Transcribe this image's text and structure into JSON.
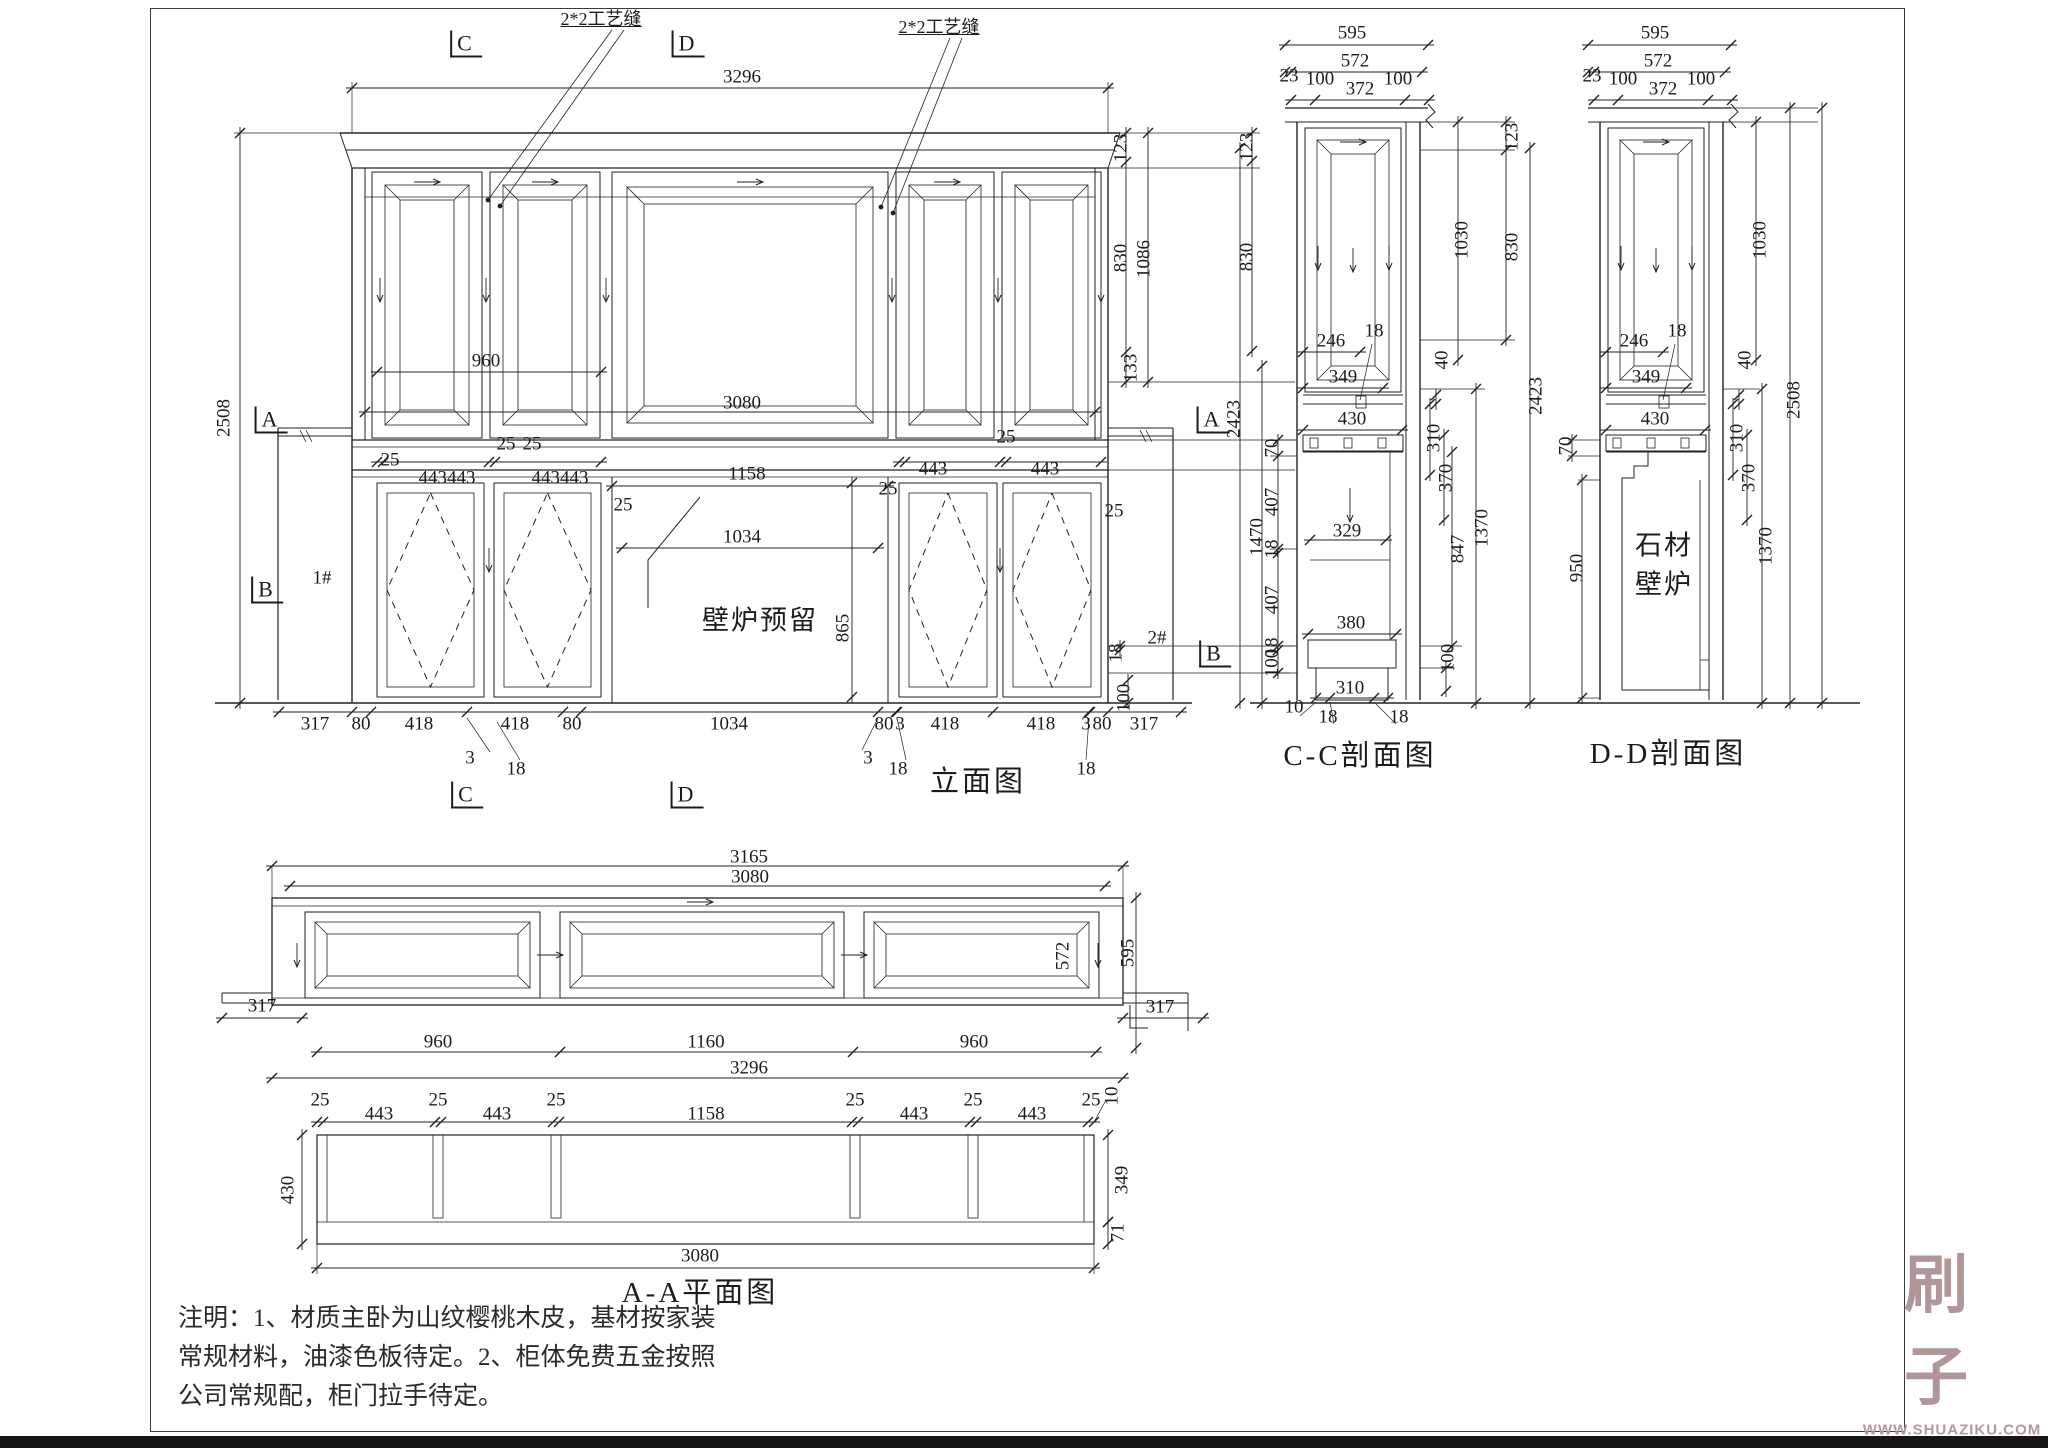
{
  "views": {
    "elevation": {
      "title": "立面图"
    },
    "section_cc": {
      "title": "C-C剖面图"
    },
    "section_dd": {
      "title": "D-D剖面图"
    },
    "plan_aa": {
      "title": "A-A平面图"
    }
  },
  "annotations": {
    "craft_seam": "2*2工艺缝",
    "fireplace_reserved": "壁炉预留",
    "stone_line1": "石材",
    "stone_line2": "壁炉",
    "unit1": "1#",
    "unit2": "2#"
  },
  "notes": {
    "lines": [
      "注明：1、材质主卧为山纹樱桃木皮，基材按家装",
      "常规材料，油漆色板待定。2、柜体免费五金按照",
      "公司常规配，柜门拉手待定。"
    ]
  },
  "watermark": {
    "logo": "刷子库",
    "url": "WWW.SHUAZIKU.COM",
    "color": "#a88b8b"
  },
  "labels": [
    {
      "t": "2*2工艺缝",
      "x": 601,
      "y": 19,
      "k": "callout"
    },
    {
      "t": "2*2工艺缝",
      "x": 939,
      "y": 27,
      "k": "callout"
    },
    {
      "t": "C",
      "x": 466,
      "y": 44,
      "k": "marker"
    },
    {
      "t": "D",
      "x": 688,
      "y": 44,
      "k": "marker"
    },
    {
      "t": "3296",
      "x": 742,
      "y": 77
    },
    {
      "t": "2508",
      "x": 224,
      "y": 418,
      "r": 1
    },
    {
      "t": "A",
      "x": 271,
      "y": 420,
      "k": "marker"
    },
    {
      "t": "B",
      "x": 267,
      "y": 590,
      "k": "marker"
    },
    {
      "t": "1#",
      "x": 322,
      "y": 578
    },
    {
      "t": "960",
      "x": 486,
      "y": 361
    },
    {
      "t": "3080",
      "x": 742,
      "y": 403
    },
    {
      "t": "25",
      "x": 506,
      "y": 444
    },
    {
      "t": "25",
      "x": 532,
      "y": 444
    },
    {
      "t": "25",
      "x": 390,
      "y": 460
    },
    {
      "t": "443443",
      "x": 447,
      "y": 478
    },
    {
      "t": "443443",
      "x": 560,
      "y": 478
    },
    {
      "t": "1158",
      "x": 747,
      "y": 474
    },
    {
      "t": "25",
      "x": 623,
      "y": 505
    },
    {
      "t": "443",
      "x": 933,
      "y": 469
    },
    {
      "t": "443",
      "x": 1045,
      "y": 469
    },
    {
      "t": "25",
      "x": 1006,
      "y": 437
    },
    {
      "t": "25",
      "x": 888,
      "y": 489
    },
    {
      "t": "25",
      "x": 1114,
      "y": 511
    },
    {
      "t": "1034",
      "x": 742,
      "y": 537
    },
    {
      "t": "865",
      "x": 843,
      "y": 628,
      "r": 1
    },
    {
      "t": "壁炉预留",
      "x": 760,
      "y": 621,
      "k": "text"
    },
    {
      "t": "2#",
      "x": 1157,
      "y": 638
    },
    {
      "t": "123",
      "x": 1121,
      "y": 148,
      "r": 1
    },
    {
      "t": "830",
      "x": 1121,
      "y": 258,
      "r": 1
    },
    {
      "t": "1086",
      "x": 1144,
      "y": 259,
      "r": 1
    },
    {
      "t": "133",
      "x": 1131,
      "y": 368,
      "r": 1
    },
    {
      "t": "123",
      "x": 1247,
      "y": 147,
      "r": 1
    },
    {
      "t": "830",
      "x": 1247,
      "y": 257,
      "r": 1
    },
    {
      "t": "A",
      "x": 1213,
      "y": 420,
      "k": "marker"
    },
    {
      "t": "2423",
      "x": 1234,
      "y": 419,
      "r": 1
    },
    {
      "t": "70",
      "x": 1272,
      "y": 448,
      "r": 1
    },
    {
      "t": "407",
      "x": 1272,
      "y": 502,
      "r": 1
    },
    {
      "t": "18",
      "x": 1272,
      "y": 549,
      "r": 1
    },
    {
      "t": "407",
      "x": 1272,
      "y": 600,
      "r": 1
    },
    {
      "t": "18",
      "x": 1272,
      "y": 647,
      "r": 1
    },
    {
      "t": "100",
      "x": 1272,
      "y": 663,
      "r": 1
    },
    {
      "t": "1470",
      "x": 1257,
      "y": 537,
      "r": 1
    },
    {
      "t": "B",
      "x": 1215,
      "y": 654,
      "k": "marker"
    },
    {
      "t": "18",
      "x": 1116,
      "y": 653,
      "r": 1
    },
    {
      "t": "100",
      "x": 1124,
      "y": 698,
      "r": 1
    },
    {
      "t": "317",
      "x": 315,
      "y": 724
    },
    {
      "t": "80",
      "x": 361,
      "y": 724
    },
    {
      "t": "418",
      "x": 419,
      "y": 724
    },
    {
      "t": "418",
      "x": 515,
      "y": 724
    },
    {
      "t": "80",
      "x": 572,
      "y": 724
    },
    {
      "t": "1034",
      "x": 729,
      "y": 724
    },
    {
      "t": "80",
      "x": 884,
      "y": 724
    },
    {
      "t": "3",
      "x": 900,
      "y": 724
    },
    {
      "t": "418",
      "x": 945,
      "y": 724
    },
    {
      "t": "418",
      "x": 1041,
      "y": 724
    },
    {
      "t": "3",
      "x": 1086,
      "y": 724
    },
    {
      "t": "80",
      "x": 1102,
      "y": 724
    },
    {
      "t": "317",
      "x": 1144,
      "y": 724
    },
    {
      "t": "3",
      "x": 470,
      "y": 758
    },
    {
      "t": "18",
      "x": 516,
      "y": 769
    },
    {
      "t": "3",
      "x": 868,
      "y": 758
    },
    {
      "t": "18",
      "x": 898,
      "y": 769
    },
    {
      "t": "18",
      "x": 1086,
      "y": 769
    },
    {
      "t": "C",
      "x": 467,
      "y": 795,
      "k": "marker"
    },
    {
      "t": "D",
      "x": 687,
      "y": 795,
      "k": "marker"
    },
    {
      "t": "595",
      "x": 1352,
      "y": 33
    },
    {
      "t": "572",
      "x": 1355,
      "y": 61
    },
    {
      "t": "23",
      "x": 1289,
      "y": 76
    },
    {
      "t": "100",
      "x": 1320,
      "y": 79
    },
    {
      "t": "372",
      "x": 1360,
      "y": 89
    },
    {
      "t": "100",
      "x": 1398,
      "y": 79
    },
    {
      "t": "1030",
      "x": 1462,
      "y": 240,
      "r": 1
    },
    {
      "t": "123",
      "x": 1512,
      "y": 137,
      "r": 1
    },
    {
      "t": "830",
      "x": 1512,
      "y": 247,
      "r": 1
    },
    {
      "t": "2423",
      "x": 1536,
      "y": 396,
      "r": 1
    },
    {
      "t": "18",
      "x": 1374,
      "y": 331
    },
    {
      "t": "246",
      "x": 1331,
      "y": 341
    },
    {
      "t": "349",
      "x": 1343,
      "y": 377
    },
    {
      "t": "430",
      "x": 1352,
      "y": 419
    },
    {
      "t": "40",
      "x": 1442,
      "y": 360,
      "r": 1
    },
    {
      "t": "310",
      "x": 1434,
      "y": 438,
      "r": 1
    },
    {
      "t": "370",
      "x": 1446,
      "y": 478,
      "r": 1
    },
    {
      "t": "329",
      "x": 1347,
      "y": 531
    },
    {
      "t": "380",
      "x": 1351,
      "y": 623
    },
    {
      "t": "310",
      "x": 1350,
      "y": 688
    },
    {
      "t": "10",
      "x": 1294,
      "y": 707
    },
    {
      "t": "18",
      "x": 1328,
      "y": 717
    },
    {
      "t": "18",
      "x": 1399,
      "y": 717
    },
    {
      "t": "847",
      "x": 1458,
      "y": 549,
      "r": 1
    },
    {
      "t": "1370",
      "x": 1482,
      "y": 528,
      "r": 1
    },
    {
      "t": "100",
      "x": 1448,
      "y": 658,
      "r": 1
    },
    {
      "t": "595",
      "x": 1655,
      "y": 33
    },
    {
      "t": "572",
      "x": 1658,
      "y": 61
    },
    {
      "t": "23",
      "x": 1592,
      "y": 76
    },
    {
      "t": "100",
      "x": 1623,
      "y": 79
    },
    {
      "t": "372",
      "x": 1663,
      "y": 89
    },
    {
      "t": "100",
      "x": 1701,
      "y": 79
    },
    {
      "t": "1030",
      "x": 1760,
      "y": 240,
      "r": 1
    },
    {
      "t": "2508",
      "x": 1794,
      "y": 400,
      "r": 1
    },
    {
      "t": "18",
      "x": 1677,
      "y": 331
    },
    {
      "t": "246",
      "x": 1634,
      "y": 341
    },
    {
      "t": "349",
      "x": 1646,
      "y": 377
    },
    {
      "t": "430",
      "x": 1655,
      "y": 419
    },
    {
      "t": "40",
      "x": 1745,
      "y": 360,
      "r": 1
    },
    {
      "t": "310",
      "x": 1737,
      "y": 438,
      "r": 1
    },
    {
      "t": "370",
      "x": 1749,
      "y": 478,
      "r": 1
    },
    {
      "t": "1370",
      "x": 1766,
      "y": 546,
      "r": 1
    },
    {
      "t": "70",
      "x": 1566,
      "y": 446,
      "r": 1
    },
    {
      "t": "950",
      "x": 1577,
      "y": 568,
      "r": 1
    },
    {
      "t": "石材",
      "x": 1664,
      "y": 546,
      "k": "text"
    },
    {
      "t": "壁炉",
      "x": 1664,
      "y": 585,
      "k": "text"
    },
    {
      "t": "3165",
      "x": 749,
      "y": 857
    },
    {
      "t": "3080",
      "x": 750,
      "y": 877
    },
    {
      "t": "317",
      "x": 262,
      "y": 1006
    },
    {
      "t": "572",
      "x": 1063,
      "y": 956,
      "r": 1
    },
    {
      "t": "595",
      "x": 1128,
      "y": 953,
      "r": 1
    },
    {
      "t": "317",
      "x": 1160,
      "y": 1007
    },
    {
      "t": "960",
      "x": 438,
      "y": 1042
    },
    {
      "t": "1160",
      "x": 706,
      "y": 1042
    },
    {
      "t": "960",
      "x": 974,
      "y": 1042
    },
    {
      "t": "3296",
      "x": 749,
      "y": 1068
    },
    {
      "t": "25",
      "x": 320,
      "y": 1100
    },
    {
      "t": "443",
      "x": 379,
      "y": 1114
    },
    {
      "t": "25",
      "x": 438,
      "y": 1100
    },
    {
      "t": "443",
      "x": 497,
      "y": 1114
    },
    {
      "t": "25",
      "x": 556,
      "y": 1100
    },
    {
      "t": "1158",
      "x": 706,
      "y": 1114
    },
    {
      "t": "25",
      "x": 855,
      "y": 1100
    },
    {
      "t": "443",
      "x": 914,
      "y": 1114
    },
    {
      "t": "25",
      "x": 973,
      "y": 1100
    },
    {
      "t": "443",
      "x": 1032,
      "y": 1114
    },
    {
      "t": "25",
      "x": 1091,
      "y": 1100
    },
    {
      "t": "10",
      "x": 1112,
      "y": 1096,
      "r": 1
    },
    {
      "t": "430",
      "x": 288,
      "y": 1190,
      "r": 1
    },
    {
      "t": "349",
      "x": 1122,
      "y": 1180,
      "r": 1
    },
    {
      "t": "71",
      "x": 1118,
      "y": 1233,
      "r": 1
    },
    {
      "t": "3080",
      "x": 700,
      "y": 1256
    }
  ]
}
